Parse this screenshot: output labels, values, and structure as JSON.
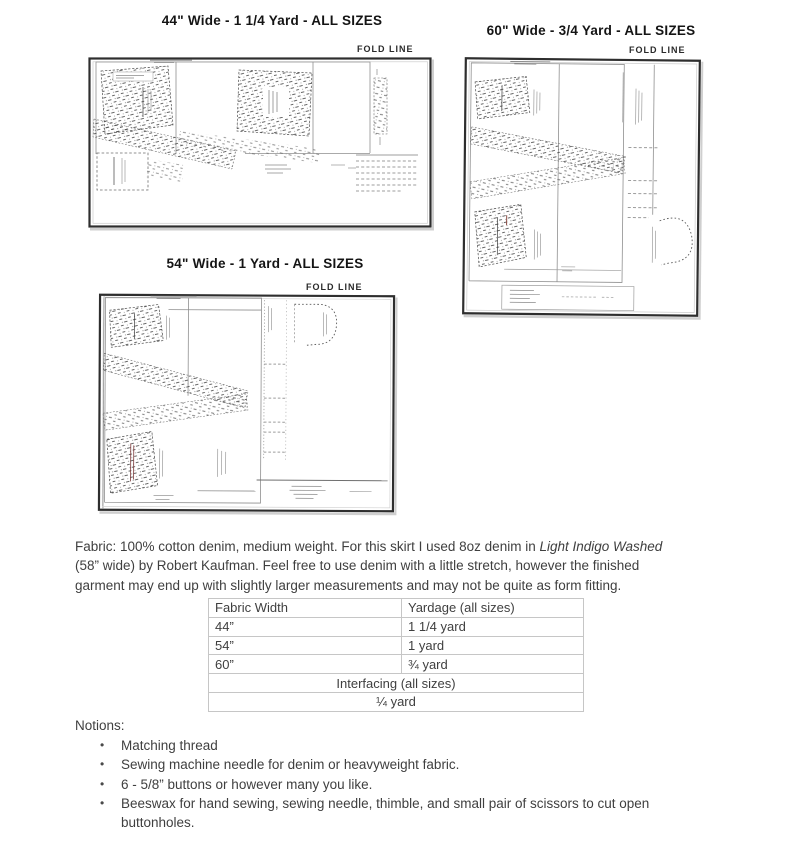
{
  "diagrams": [
    {
      "title": "44\" Wide - 1 1/4 Yard - ALL SIZES",
      "fold_line": "FOLD LINE"
    },
    {
      "title": "60\" Wide - 3/4 Yard - ALL SIZES",
      "fold_line": "FOLD LINE"
    },
    {
      "title": "54\" Wide - 1 Yard - ALL SIZES",
      "fold_line": "FOLD LINE"
    }
  ],
  "fabric_paragraph": {
    "line1_regular": "Fabric: 100% cotton denim, medium weight. For this skirt I used 8oz denim in ",
    "line1_italic": "Light Indigo Washed",
    "line2": "(58” wide) by Robert Kaufman. Feel free to use denim with a little stretch, however the finished",
    "line3": "garment may end up with slightly larger measurements and may not be quite as form fitting."
  },
  "yardage_table": {
    "headers": [
      "Fabric Width",
      "Yardage (all sizes)"
    ],
    "rows": [
      {
        "width": "44”",
        "yardage": "1 1/4 yard"
      },
      {
        "width": "54”",
        "yardage": "1 yard"
      },
      {
        "width": "60”",
        "yardage": "¾ yard"
      }
    ],
    "interfacing_header": "Interfacing (all sizes)",
    "interfacing_value": "¼ yard"
  },
  "notions": {
    "label": "Notions:",
    "bullet": "•",
    "items": [
      "Matching thread",
      "Sewing machine needle for denim or heavyweight fabric.",
      "6 - 5/8” buttons or however many you like.",
      "Beeswax for hand sewing, sewing needle, thimble, and small pair of scissors to cut open buttonholes."
    ]
  },
  "colors": {
    "body_text": "#3f3f3f",
    "title_text": "#141414",
    "table_border": "#c6c6c6",
    "diagram_border": "#2e2e2e"
  }
}
